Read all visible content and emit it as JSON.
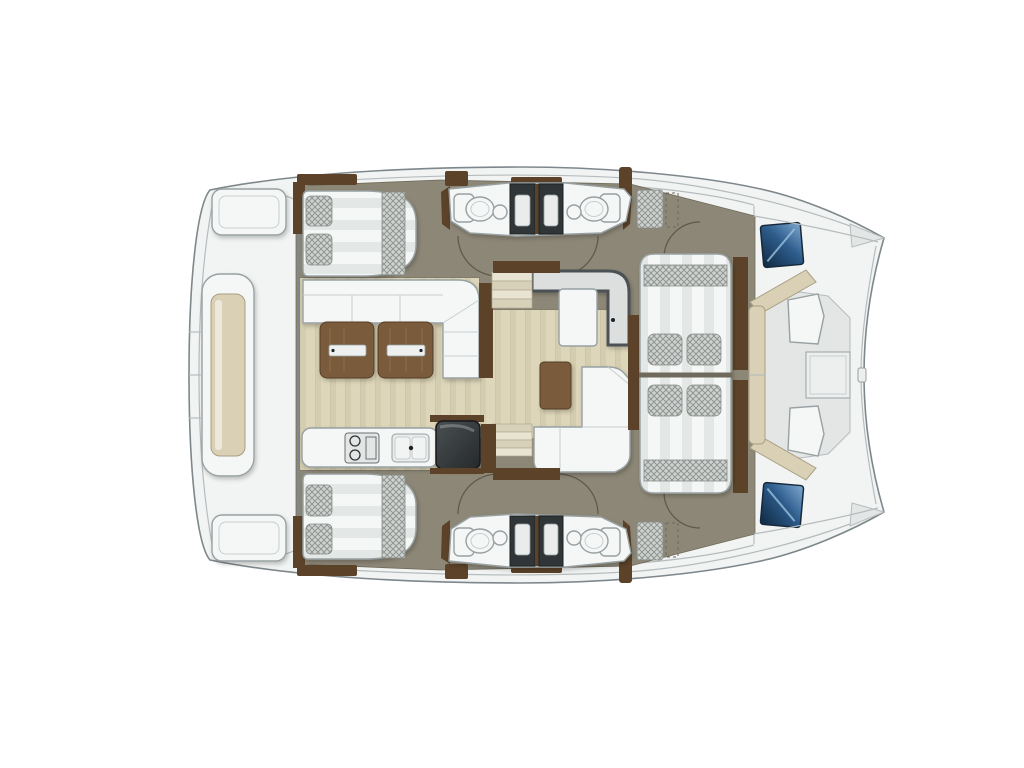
{
  "document": {
    "kind": "floor-plan-illustration",
    "subject": "catamaran-deck-plan-top-view",
    "orientation": {
      "bow": "right",
      "stern": "left"
    },
    "background": "#ffffff"
  },
  "palette": {
    "bg": "#ffffff",
    "hull": "#f2f4f3",
    "outline": "#7e878b",
    "seam": "#b6bcbe",
    "floor": "#8d8777",
    "floordark": "#6f6a5b",
    "furn": "#f5f7f6",
    "furnstroke": "#98a0a2",
    "furnline": "#c7cdce",
    "wood": "#7a5b3d",
    "wooddark": "#563e27",
    "woodlight": "#9a7a52",
    "trim": "#5b4229",
    "cushion": "#d9d0b6",
    "cushionstroke": "#a99f83",
    "dark": "#303537",
    "darker": "#1d2123",
    "tray": "#e9eceb",
    "chk_base": "#ced2d0",
    "chk_line": "#8f9590",
    "chkline": "#878c88",
    "arc": "#5e574a",
    "step_a": "#e9e3d1",
    "step_b": "#d8d1ba",
    "step_edge": "#b1a990",
    "deck_sub": "#e3e6e5",
    "deck_panel": "#edefee",
    "inlay": "#edf0ef",
    "plank_base": "#ddd6ba",
    "plank_band": "#d4cdaf",
    "plank_line": "#c8c0a4",
    "stripe_base": "#f5f7f6",
    "stripe_band": "#e3e7e6",
    "hatch_deep": "#0f2840",
    "hatch_mid": "#2e5d8d",
    "hatch_light": "#7fa9d0"
  },
  "inventory": {
    "hull_double_beds": 2,
    "bow_lounge_berths": 2,
    "toilets": 4,
    "washbasins": 4,
    "shower_stalls": 4,
    "salon_sofas": 2,
    "salon_tables": 1,
    "coffee_tables": 1,
    "counter_units": 1,
    "galley": {
      "cooktops": 1,
      "sink_basins": 2,
      "fridges": 1
    },
    "stair_flights": 2,
    "foredeck_hatches": 2,
    "stern_benches": 2,
    "tender_platforms": 1,
    "door_swings": 6,
    "deck_locker_patches": 2
  }
}
